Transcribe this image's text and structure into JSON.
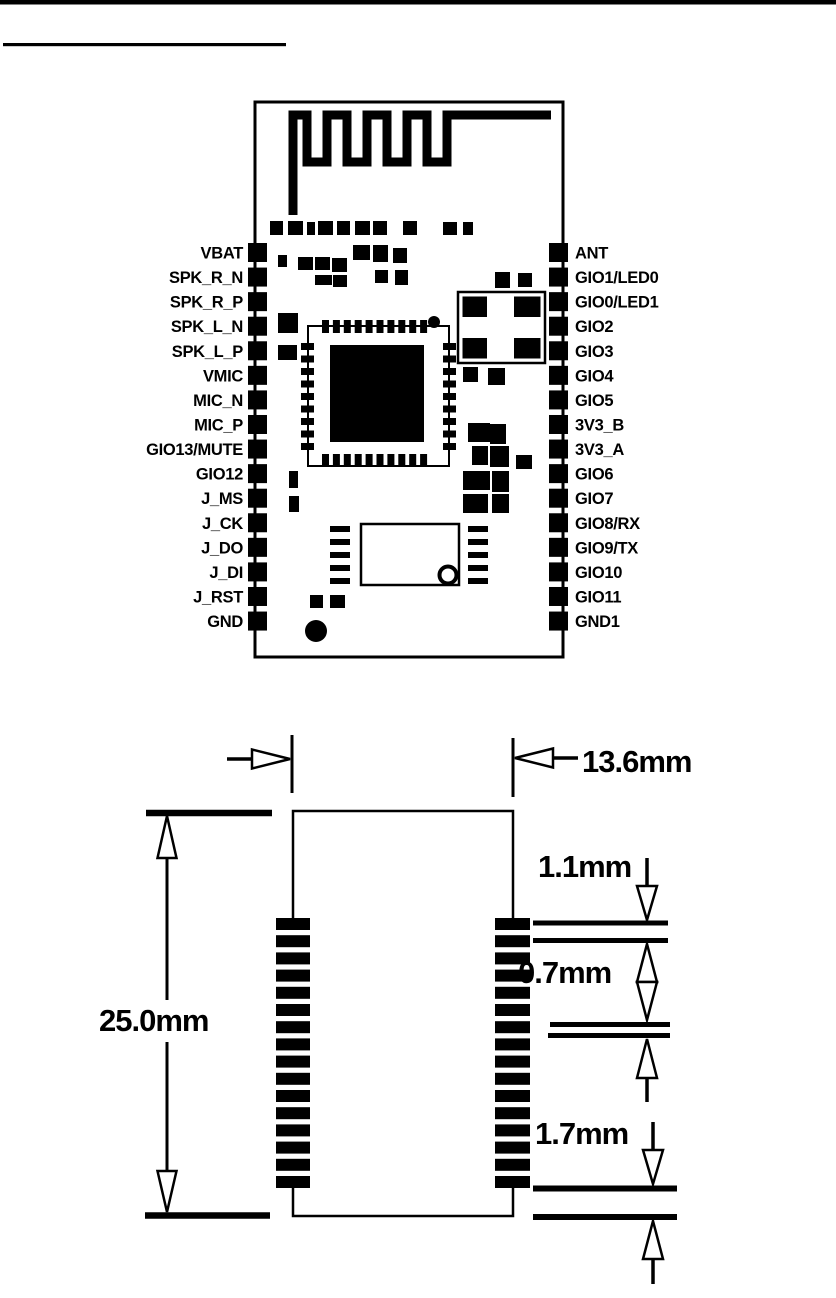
{
  "page": {
    "kind": "datasheet-diagram",
    "colors": {
      "ink": "#000000",
      "paper": "#ffffff"
    }
  },
  "module": {
    "left_pins": [
      "VBAT",
      "SPK_R_N",
      "SPK_R_P",
      "SPK_L_N",
      "SPK_L_P",
      "VMIC",
      "MIC_N",
      "MIC_P",
      "GIO13/MUTE",
      "GIO12",
      "J_MS",
      "J_CK",
      "J_DO",
      "J_DI",
      "J_RST",
      "GND"
    ],
    "right_pins": [
      "ANT",
      "GIO1/LED0",
      "GIO0/LED1",
      "GIO2",
      "GIO3",
      "GIO4",
      "GIO5",
      "3V3_B",
      "3V3_A",
      "GIO6",
      "GIO7",
      "GIO8/RX",
      "GIO9/TX",
      "GIO10",
      "GIO11",
      "GND1"
    ]
  },
  "dimensions": {
    "body_width": "13.6mm",
    "body_height": "25.0mm",
    "pad_top_offset": "1.1mm",
    "pad_gap": "0.7mm",
    "pad_bottom_offset": "1.7mm"
  }
}
